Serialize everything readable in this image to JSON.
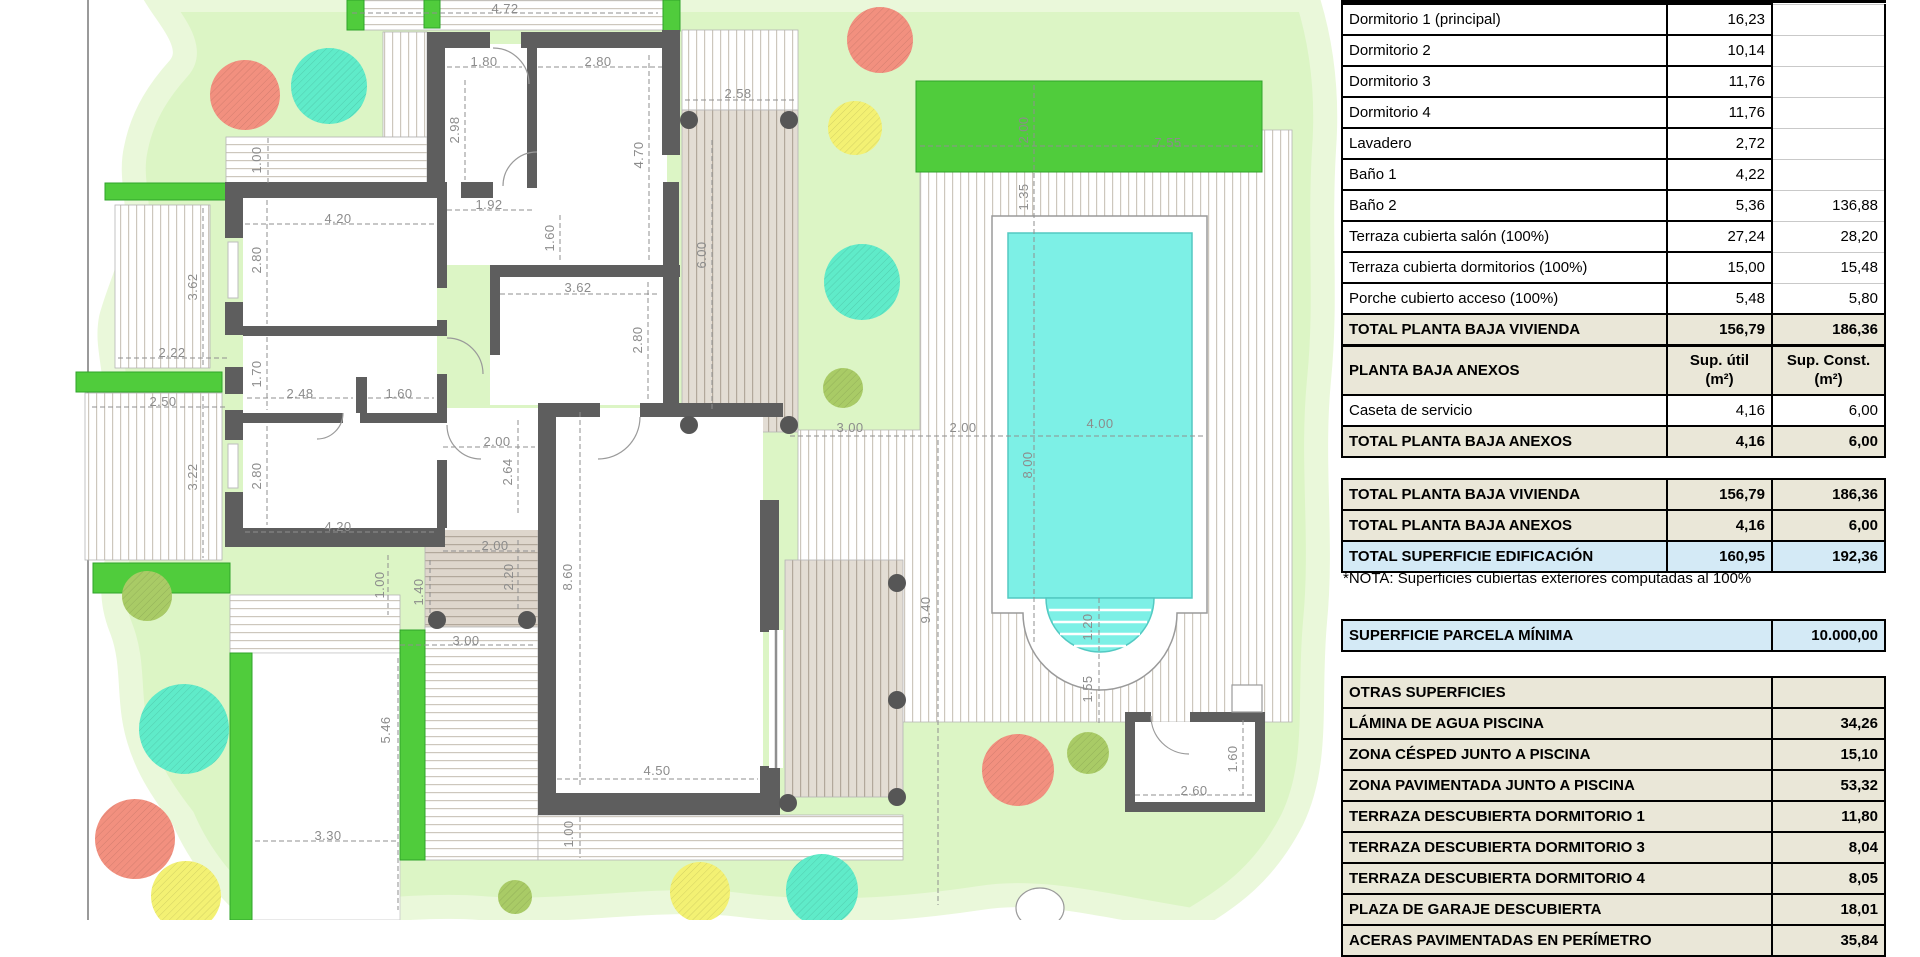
{
  "plan": {
    "colors": {
      "garden": "#dcf5c5",
      "garden_edge": "#eaf8da",
      "hedge": "#50cc3c",
      "hedge_border": "#2fa32a",
      "pool_water": "#7df0e6",
      "pool_border": "#53c9c2",
      "wall": "#5e5e5e",
      "tree_red": "#f2907f",
      "tree_teal": "#5febc9",
      "tree_yellow": "#f3f173",
      "tree_olive": "#a9cb66",
      "dim_text": "#8c8c8c",
      "table_beige": "#eae7d8",
      "table_blue": "#d4eaf6"
    },
    "dim_labels": [
      {
        "x": 505,
        "y": 9,
        "r": 0,
        "t": "4.72"
      },
      {
        "x": 484,
        "y": 62,
        "r": 0,
        "t": "1.80"
      },
      {
        "x": 598,
        "y": 62,
        "r": 0,
        "t": "2.80"
      },
      {
        "x": 459,
        "y": 130,
        "r": 90,
        "t": "2.98"
      },
      {
        "x": 643,
        "y": 155,
        "r": 90,
        "t": "4.70"
      },
      {
        "x": 738,
        "y": 94,
        "r": 0,
        "t": "2.58"
      },
      {
        "x": 489,
        "y": 205,
        "r": 0,
        "t": "1.92"
      },
      {
        "x": 554,
        "y": 238,
        "r": 90,
        "t": "1.60"
      },
      {
        "x": 338,
        "y": 219,
        "r": 0,
        "t": "4.20"
      },
      {
        "x": 261,
        "y": 260,
        "r": 90,
        "t": "2.80"
      },
      {
        "x": 197,
        "y": 287,
        "r": 90,
        "t": "3.62"
      },
      {
        "x": 578,
        "y": 288,
        "r": 0,
        "t": "3.62"
      },
      {
        "x": 642,
        "y": 340,
        "r": 90,
        "t": "2.80"
      },
      {
        "x": 172,
        "y": 353,
        "r": 0,
        "t": "2.22"
      },
      {
        "x": 261,
        "y": 374,
        "r": 90,
        "t": "1.70"
      },
      {
        "x": 300,
        "y": 394,
        "r": 0,
        "t": "2.48"
      },
      {
        "x": 399,
        "y": 394,
        "r": 0,
        "t": "1.60"
      },
      {
        "x": 163,
        "y": 402,
        "r": 0,
        "t": "2.50"
      },
      {
        "x": 197,
        "y": 477,
        "r": 90,
        "t": "3.22"
      },
      {
        "x": 261,
        "y": 476,
        "r": 90,
        "t": "2.80"
      },
      {
        "x": 338,
        "y": 527,
        "r": 0,
        "t": "4.20"
      },
      {
        "x": 497,
        "y": 442,
        "r": 0,
        "t": "2.00"
      },
      {
        "x": 512,
        "y": 472,
        "r": 90,
        "t": "2.64"
      },
      {
        "x": 495,
        "y": 546,
        "r": 0,
        "t": "2.00"
      },
      {
        "x": 513,
        "y": 577,
        "r": 90,
        "t": "2.20"
      },
      {
        "x": 384,
        "y": 585,
        "r": 90,
        "t": "1.00"
      },
      {
        "x": 423,
        "y": 592,
        "r": 90,
        "t": "1.40"
      },
      {
        "x": 466,
        "y": 641,
        "r": 0,
        "t": "3.00"
      },
      {
        "x": 572,
        "y": 577,
        "r": 90,
        "t": "8.60"
      },
      {
        "x": 390,
        "y": 730,
        "r": 90,
        "t": "5.46"
      },
      {
        "x": 328,
        "y": 836,
        "r": 0,
        "t": "3.30"
      },
      {
        "x": 657,
        "y": 771,
        "r": 0,
        "t": "4.50"
      },
      {
        "x": 573,
        "y": 834,
        "r": 90,
        "t": "1.00"
      },
      {
        "x": 261,
        "y": 160,
        "r": 90,
        "t": "1.00"
      },
      {
        "x": 706,
        "y": 255,
        "r": 90,
        "t": "6.00"
      },
      {
        "x": 930,
        "y": 610,
        "r": 90,
        "t": "9.40"
      },
      {
        "x": 1032,
        "y": 465,
        "r": 90,
        "t": "8.00"
      },
      {
        "x": 1100,
        "y": 424,
        "r": 0,
        "t": "4.00"
      },
      {
        "x": 850,
        "y": 428,
        "r": 0,
        "t": "3.00"
      },
      {
        "x": 963,
        "y": 428,
        "r": 0,
        "t": "2.00"
      },
      {
        "x": 1028,
        "y": 130,
        "r": 90,
        "t": "2.00"
      },
      {
        "x": 1168,
        "y": 143,
        "r": 0,
        "t": "7.55"
      },
      {
        "x": 1028,
        "y": 197,
        "r": 90,
        "t": "1.35"
      },
      {
        "x": 1092,
        "y": 627,
        "r": 90,
        "t": "1.20"
      },
      {
        "x": 1092,
        "y": 689,
        "r": 90,
        "t": "1.55"
      },
      {
        "x": 1194,
        "y": 791,
        "r": 0,
        "t": "2.60"
      },
      {
        "x": 1237,
        "y": 759,
        "r": 90,
        "t": "1.60"
      }
    ],
    "trees": [
      {
        "x": 245,
        "y": 95,
        "rad": 35,
        "c": "red"
      },
      {
        "x": 329,
        "y": 86,
        "rad": 38,
        "c": "teal"
      },
      {
        "x": 880,
        "y": 40,
        "rad": 33,
        "c": "red"
      },
      {
        "x": 855,
        "y": 128,
        "rad": 27,
        "c": "yellow"
      },
      {
        "x": 862,
        "y": 282,
        "rad": 38,
        "c": "teal"
      },
      {
        "x": 843,
        "y": 388,
        "rad": 20,
        "c": "olive"
      },
      {
        "x": 147,
        "y": 596,
        "rad": 25,
        "c": "olive"
      },
      {
        "x": 184,
        "y": 729,
        "rad": 45,
        "c": "teal"
      },
      {
        "x": 135,
        "y": 839,
        "rad": 40,
        "c": "red"
      },
      {
        "x": 186,
        "y": 896,
        "rad": 35,
        "c": "yellow"
      },
      {
        "x": 1018,
        "y": 770,
        "rad": 36,
        "c": "red"
      },
      {
        "x": 1088,
        "y": 753,
        "rad": 21,
        "c": "olive"
      },
      {
        "x": 515,
        "y": 897,
        "rad": 17,
        "c": "olive"
      },
      {
        "x": 700,
        "y": 892,
        "rad": 30,
        "c": "yellow"
      },
      {
        "x": 822,
        "y": 890,
        "rad": 36,
        "c": "teal"
      }
    ],
    "posts": [
      [
        689,
        120
      ],
      [
        789,
        120
      ],
      [
        689,
        425
      ],
      [
        789,
        425
      ],
      [
        437,
        620
      ],
      [
        527,
        620
      ],
      [
        788,
        803
      ],
      [
        897,
        797
      ],
      [
        897,
        583
      ],
      [
        897,
        700
      ]
    ]
  },
  "tables": {
    "vivienda": {
      "rows": [
        {
          "label": "Dormitorio 1 (principal)",
          "util": "16,23",
          "cons": ""
        },
        {
          "label": "Dormitorio 2",
          "util": "10,14",
          "cons": ""
        },
        {
          "label": "Dormitorio 3",
          "util": "11,76",
          "cons": ""
        },
        {
          "label": "Dormitorio 4",
          "util": "11,76",
          "cons": ""
        },
        {
          "label": "Lavadero",
          "util": "2,72",
          "cons": ""
        },
        {
          "label": "Baño 1",
          "util": "4,22",
          "cons": ""
        },
        {
          "label": "Baño 2",
          "util": "5,36",
          "cons": "136,88"
        },
        {
          "label": "Terraza cubierta salón (100%)",
          "util": "27,24",
          "cons": "28,20"
        },
        {
          "label": "Terraza cubierta dormitorios (100%)",
          "util": "15,00",
          "cons": "15,48"
        },
        {
          "label": "Porche cubierto acceso (100%)",
          "util": "5,48",
          "cons": "5,80"
        }
      ],
      "total": {
        "label": "TOTAL PLANTA BAJA VIVIENDA",
        "util": "156,79",
        "cons": "186,36"
      }
    },
    "anexos": {
      "header": {
        "label": "PLANTA BAJA ANEXOS",
        "util": "Sup. útil\n(m²)",
        "cons": "Sup. Const.\n(m²)"
      },
      "rows": [
        {
          "label": "Caseta de servicio",
          "util": "4,16",
          "cons": "6,00"
        }
      ],
      "total": {
        "label": "TOTAL PLANTA BAJA ANEXOS",
        "util": "4,16",
        "cons": "6,00"
      }
    },
    "resumen": {
      "rows": [
        {
          "label": "TOTAL PLANTA BAJA VIVIENDA",
          "util": "156,79",
          "cons": "186,36",
          "style": "beige"
        },
        {
          "label": "TOTAL PLANTA BAJA ANEXOS",
          "util": "4,16",
          "cons": "6,00",
          "style": "beige"
        },
        {
          "label": "TOTAL SUPERFICIE EDIFICACIÓN",
          "util": "160,95",
          "cons": "192,36",
          "style": "blue"
        }
      ],
      "nota": "*NOTA: Superficies cubiertas exteriores computadas al 100%"
    },
    "parcela": {
      "label": "SUPERFICIE PARCELA MÍNIMA",
      "value": "10.000,00"
    },
    "otras": {
      "header": "OTRAS SUPERFICIES",
      "rows": [
        {
          "label": "LÁMINA DE AGUA PISCINA",
          "value": "34,26"
        },
        {
          "label": "ZONA CÉSPED JUNTO A PISCINA",
          "value": "15,10"
        },
        {
          "label": "ZONA PAVIMENTADA JUNTO A PISCINA",
          "value": "53,32"
        },
        {
          "label": "TERRAZA DESCUBIERTA DORMITORIO 1",
          "value": "11,80"
        },
        {
          "label": "TERRAZA DESCUBIERTA DORMITORIO 3",
          "value": "8,04"
        },
        {
          "label": "TERRAZA DESCUBIERTA DORMITORIO 4",
          "value": "8,05"
        },
        {
          "label": "PLAZA DE GARAJE DESCUBIERTA",
          "value": "18,01"
        },
        {
          "label": "ACERAS PAVIMENTADAS EN PERÍMETRO",
          "value": "35,84"
        }
      ]
    }
  }
}
